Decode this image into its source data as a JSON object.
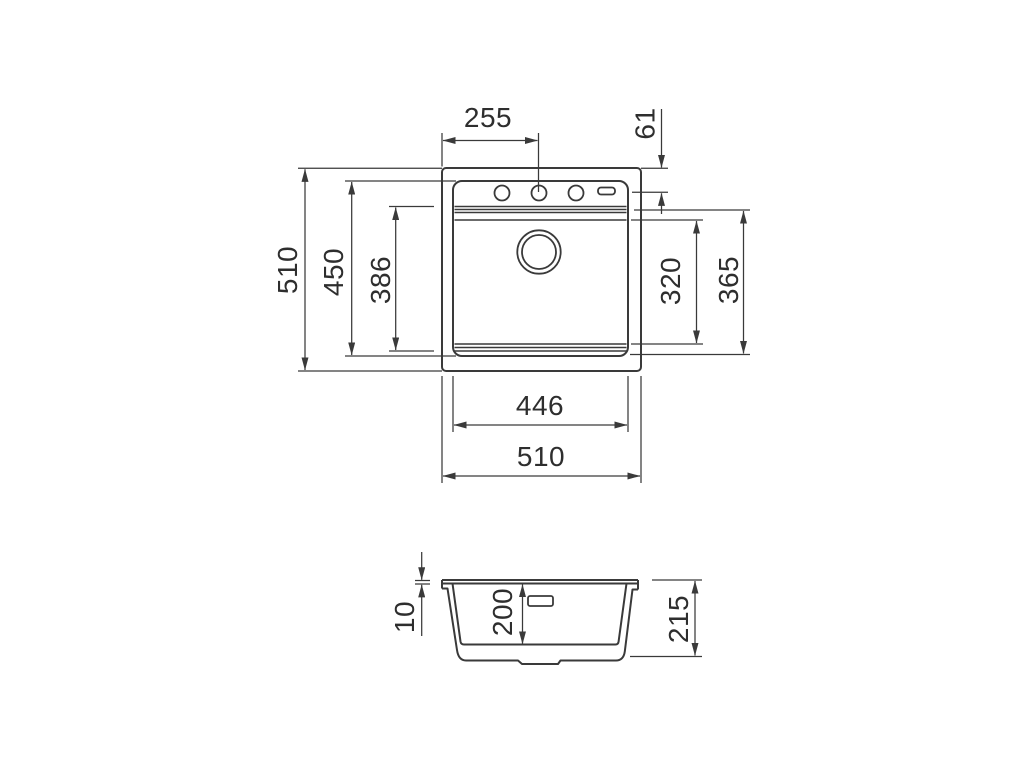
{
  "dims": {
    "top_view": {
      "faucet_center_offset": "255",
      "faucet_edge_distance": "61",
      "overall_height": "510",
      "bowl_unit_height": "450",
      "bowl_front_depth": "386",
      "bowl_inner_length": "320",
      "bowl_outer_length": "365",
      "bowl_inner_width": "446",
      "overall_width": "510"
    },
    "side_view": {
      "rim_thickness": "10",
      "bowl_depth": "200",
      "overall_depth": "215"
    }
  },
  "colors": {
    "line": "#3a3a3a",
    "text": "#2e2e2e",
    "background": "#ffffff"
  }
}
